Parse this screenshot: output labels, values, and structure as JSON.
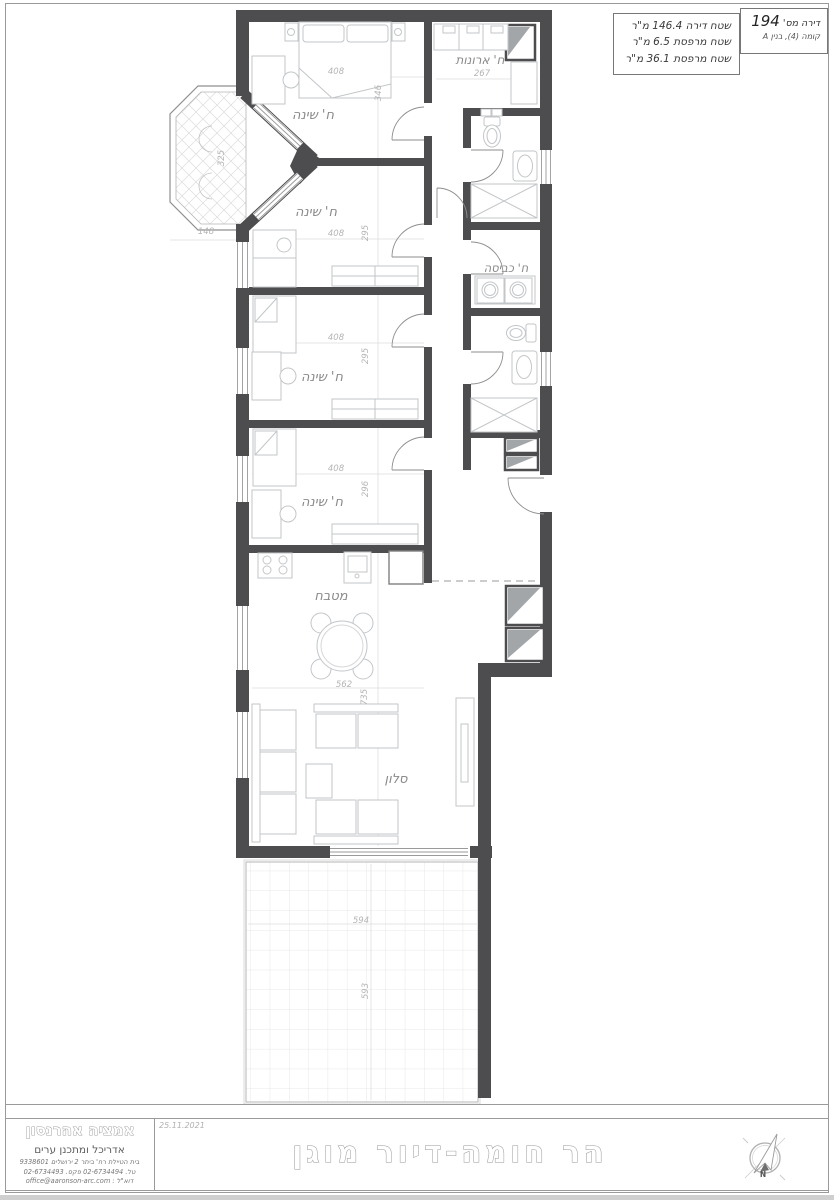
{
  "info_box": {
    "apartment_label": "דירה מס'",
    "apartment_number": "194",
    "floor_line": "קומה (4), בנין A",
    "area_apartment": "שטח דירה 146.4 מ\"ר",
    "area_balcony_1": "שטח מרפסת 6.5 מ\"ר",
    "area_balcony_2": "שטח מרפסת 36.1 מ\"ר"
  },
  "plan": {
    "rooms": {
      "bedroom": "ח' שינה",
      "closets": "ח' ארונות",
      "laundry": "ח' כביסה",
      "kitchen": "מטבח",
      "living": "סלון"
    },
    "dims": {
      "d408": "408",
      "d346": "346",
      "d295": "295",
      "d296": "296",
      "d267": "267",
      "d148": "148",
      "d325": "325",
      "d562": "562",
      "d735": "735",
      "d594": "594",
      "d593": "593"
    }
  },
  "title_block": {
    "architect_name": "אמציה אהרנסון",
    "architect_role": "אדריכל ומתכנן ערים",
    "address": "בית הטיילת רח' ביתר 2 ירושלים 9338601",
    "phones": "טל. 02-6734494 פקס. 02-6734493",
    "email": "דוא\"ל : office@aaronson-arc.com",
    "date": "25.11.2021",
    "project_title": "הר חומה-דיור מוגן",
    "north": "N"
  }
}
